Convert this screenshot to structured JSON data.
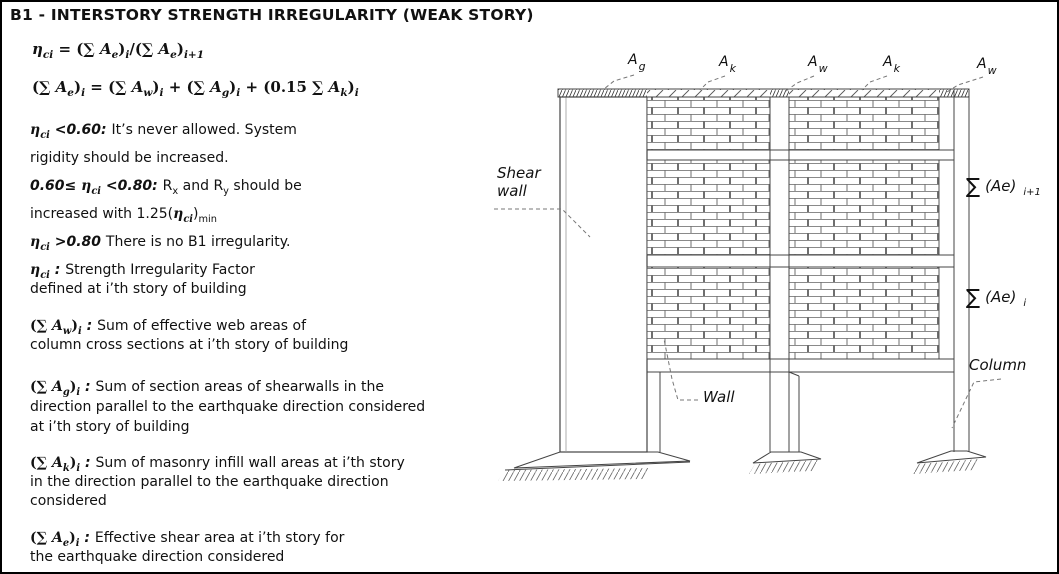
{
  "title": "B1 - INTERSTORY STRENGTH IRREGULARITY (WEAK STORY)",
  "formulas": {
    "f1": [
      {
        "t": "η",
        "f": 1,
        "i": 1,
        "b": 1
      },
      {
        "t": "ci",
        "f": 1,
        "i": 1,
        "b": 1,
        "sub": 1
      },
      {
        "t": " = (",
        "f": 1,
        "b": 1
      },
      {
        "t": "∑",
        "f": 1,
        "b": 1
      },
      {
        "t": " A",
        "f": 1,
        "i": 1,
        "b": 1
      },
      {
        "t": "e",
        "f": 1,
        "i": 1,
        "b": 1,
        "sub": 1
      },
      {
        "t": ")",
        "f": 1,
        "b": 1
      },
      {
        "t": "i",
        "f": 1,
        "i": 1,
        "b": 1,
        "sub": 1
      },
      {
        "t": "/(",
        "f": 1,
        "b": 1
      },
      {
        "t": "∑",
        "f": 1,
        "b": 1
      },
      {
        "t": " A",
        "f": 1,
        "i": 1,
        "b": 1
      },
      {
        "t": "e",
        "f": 1,
        "i": 1,
        "b": 1,
        "sub": 1
      },
      {
        "t": ")",
        "f": 1,
        "b": 1
      },
      {
        "t": "i+1",
        "f": 1,
        "i": 1,
        "b": 1,
        "sub": 1
      }
    ],
    "f2": [
      {
        "t": "(",
        "f": 1,
        "b": 1
      },
      {
        "t": "∑",
        "f": 1,
        "b": 1
      },
      {
        "t": " A",
        "f": 1,
        "i": 1,
        "b": 1
      },
      {
        "t": "e",
        "f": 1,
        "i": 1,
        "b": 1,
        "sub": 1
      },
      {
        "t": ")",
        "f": 1,
        "b": 1
      },
      {
        "t": "i",
        "f": 1,
        "i": 1,
        "b": 1,
        "sub": 1
      },
      {
        "t": " = (",
        "f": 1,
        "b": 1
      },
      {
        "t": "∑",
        "f": 1,
        "b": 1
      },
      {
        "t": " A",
        "f": 1,
        "i": 1,
        "b": 1
      },
      {
        "t": "w",
        "f": 1,
        "i": 1,
        "b": 1,
        "sub": 1
      },
      {
        "t": ")",
        "f": 1,
        "b": 1
      },
      {
        "t": "i",
        "f": 1,
        "i": 1,
        "b": 1,
        "sub": 1
      },
      {
        "t": " + (",
        "f": 1,
        "b": 1
      },
      {
        "t": "∑",
        "f": 1,
        "b": 1
      },
      {
        "t": " A",
        "f": 1,
        "i": 1,
        "b": 1
      },
      {
        "t": "g",
        "f": 1,
        "i": 1,
        "b": 1,
        "sub": 1
      },
      {
        "t": ")",
        "f": 1,
        "b": 1
      },
      {
        "t": "i",
        "f": 1,
        "i": 1,
        "b": 1,
        "sub": 1
      },
      {
        "t": " + (0.15 ",
        "f": 1,
        "b": 1
      },
      {
        "t": "∑",
        "f": 1,
        "b": 1
      },
      {
        "t": " A",
        "f": 1,
        "i": 1,
        "b": 1
      },
      {
        "t": "k",
        "f": 1,
        "i": 1,
        "b": 1,
        "sub": 1
      },
      {
        "t": ")",
        "f": 1,
        "b": 1
      },
      {
        "t": "i",
        "f": 1,
        "i": 1,
        "b": 1,
        "sub": 1
      }
    ]
  },
  "conditions": {
    "lines": [
      [
        {
          "t": "η",
          "f": 1,
          "i": 1,
          "b": 1
        },
        {
          "t": "ci",
          "f": 1,
          "i": 1,
          "b": 1,
          "sub": 1
        },
        {
          "t": " <0.60: ",
          "i": 1,
          "b": 1
        },
        {
          "t": "It’s never allowed. System"
        }
      ],
      [
        {
          "t": "rigidity should be increased."
        }
      ],
      [
        {
          "t": "0.60≤ ",
          "i": 1,
          "b": 1
        },
        {
          "t": "η",
          "f": 1,
          "i": 1,
          "b": 1
        },
        {
          "t": "ci",
          "f": 1,
          "i": 1,
          "b": 1,
          "sub": 1
        },
        {
          "t": " <0.80: ",
          "i": 1,
          "b": 1
        },
        {
          "t": "R"
        },
        {
          "t": "x",
          "sub": 1
        },
        {
          "t": " and R"
        },
        {
          "t": "y",
          "sub": 1
        },
        {
          "t": " should be"
        }
      ],
      [
        {
          "t": "increased with 1.25("
        },
        {
          "t": "η",
          "f": 1,
          "i": 1,
          "b": 1
        },
        {
          "t": "ci",
          "f": 1,
          "i": 1,
          "b": 1,
          "sub": 1
        },
        {
          "t": ")"
        },
        {
          "t": "min",
          "sub": 1
        }
      ],
      [
        {
          "t": "η",
          "f": 1,
          "i": 1,
          "b": 1
        },
        {
          "t": "ci",
          "f": 1,
          "i": 1,
          "b": 1,
          "sub": 1
        },
        {
          "t": " >0.80 ",
          "i": 1,
          "b": 1
        },
        {
          "t": "There is no B1 irregularity."
        }
      ]
    ]
  },
  "definitions": {
    "d1": {
      "l1": [
        {
          "t": "η",
          "f": 1,
          "i": 1,
          "b": 1
        },
        {
          "t": "ci",
          "f": 1,
          "i": 1,
          "b": 1,
          "sub": 1
        },
        {
          "t": " : ",
          "i": 1,
          "b": 1
        },
        {
          "t": "Strength Irregularity Factor"
        }
      ],
      "l2": [
        {
          "t": "defined at i’th story of building"
        }
      ]
    },
    "d2": {
      "l1": [
        {
          "t": "(",
          "f": 1,
          "b": 1
        },
        {
          "t": "∑",
          "f": 1,
          "b": 1
        },
        {
          "t": " A",
          "f": 1,
          "i": 1,
          "b": 1
        },
        {
          "t": "w",
          "f": 1,
          "i": 1,
          "b": 1,
          "sub": 1
        },
        {
          "t": ")",
          "f": 1,
          "b": 1
        },
        {
          "t": "i",
          "f": 1,
          "i": 1,
          "b": 1,
          "sub": 1
        },
        {
          "t": " : ",
          "i": 1,
          "b": 1
        },
        {
          "t": "Sum of effective web areas of"
        }
      ],
      "l2": [
        {
          "t": "column cross sections at i’th story of building"
        }
      ]
    },
    "d3": {
      "l1": [
        {
          "t": "(",
          "f": 1,
          "b": 1
        },
        {
          "t": "∑",
          "f": 1,
          "b": 1
        },
        {
          "t": " A",
          "f": 1,
          "i": 1,
          "b": 1
        },
        {
          "t": "g",
          "f": 1,
          "i": 1,
          "b": 1,
          "sub": 1
        },
        {
          "t": ")",
          "f": 1,
          "b": 1
        },
        {
          "t": "i",
          "f": 1,
          "i": 1,
          "b": 1,
          "sub": 1
        },
        {
          "t": " : ",
          "i": 1,
          "b": 1
        },
        {
          "t": "Sum of section areas of shearwalls in the"
        }
      ],
      "l2": [
        {
          "t": "direction parallel to the earthquake direction considered"
        }
      ],
      "l3": [
        {
          "t": "at i’th story of building"
        }
      ]
    },
    "d4": {
      "l1": [
        {
          "t": "(",
          "f": 1,
          "b": 1
        },
        {
          "t": "∑",
          "f": 1,
          "b": 1
        },
        {
          "t": " A",
          "f": 1,
          "i": 1,
          "b": 1
        },
        {
          "t": "k",
          "f": 1,
          "i": 1,
          "b": 1,
          "sub": 1
        },
        {
          "t": ")",
          "f": 1,
          "b": 1
        },
        {
          "t": "i",
          "f": 1,
          "i": 1,
          "b": 1,
          "sub": 1
        },
        {
          "t": " : ",
          "i": 1,
          "b": 1
        },
        {
          "t": "Sum of masonry infill wall areas at i’th story"
        }
      ],
      "l2": [
        {
          "t": "in the direction parallel to the earthquake direction"
        }
      ],
      "l3": [
        {
          "t": "considered"
        }
      ]
    },
    "d5": {
      "l1": [
        {
          "t": "(",
          "f": 1,
          "b": 1
        },
        {
          "t": "∑",
          "f": 1,
          "b": 1
        },
        {
          "t": " A",
          "f": 1,
          "i": 1,
          "b": 1
        },
        {
          "t": "e",
          "f": 1,
          "i": 1,
          "b": 1,
          "sub": 1
        },
        {
          "t": ")",
          "f": 1,
          "b": 1
        },
        {
          "t": "i",
          "f": 1,
          "i": 1,
          "b": 1,
          "sub": 1
        },
        {
          "t": " : ",
          "i": 1,
          "b": 1
        },
        {
          "t": "Effective shear area at i’th story for"
        }
      ],
      "l2": [
        {
          "t": "the earthquake direction considered"
        }
      ]
    }
  },
  "diagram": {
    "area_labels": [
      {
        "main": "A",
        "sub": "g"
      },
      {
        "main": "A",
        "sub": "k"
      },
      {
        "main": "A",
        "sub": "w"
      },
      {
        "main": "A",
        "sub": "k"
      },
      {
        "main": "A",
        "sub": "w"
      }
    ],
    "shear_wall_label": {
      "line1": "Shear",
      "line2": "wall"
    },
    "wall_label": "Wall",
    "column_label": "Column",
    "sum_upper": {
      "sigma": "∑",
      "body": "(Ae)",
      "sub": "i+1"
    },
    "sum_lower": {
      "sigma": "∑",
      "body": "(Ae)",
      "sub": "i"
    },
    "line_color": "#444444",
    "leader_color": "#777777"
  }
}
